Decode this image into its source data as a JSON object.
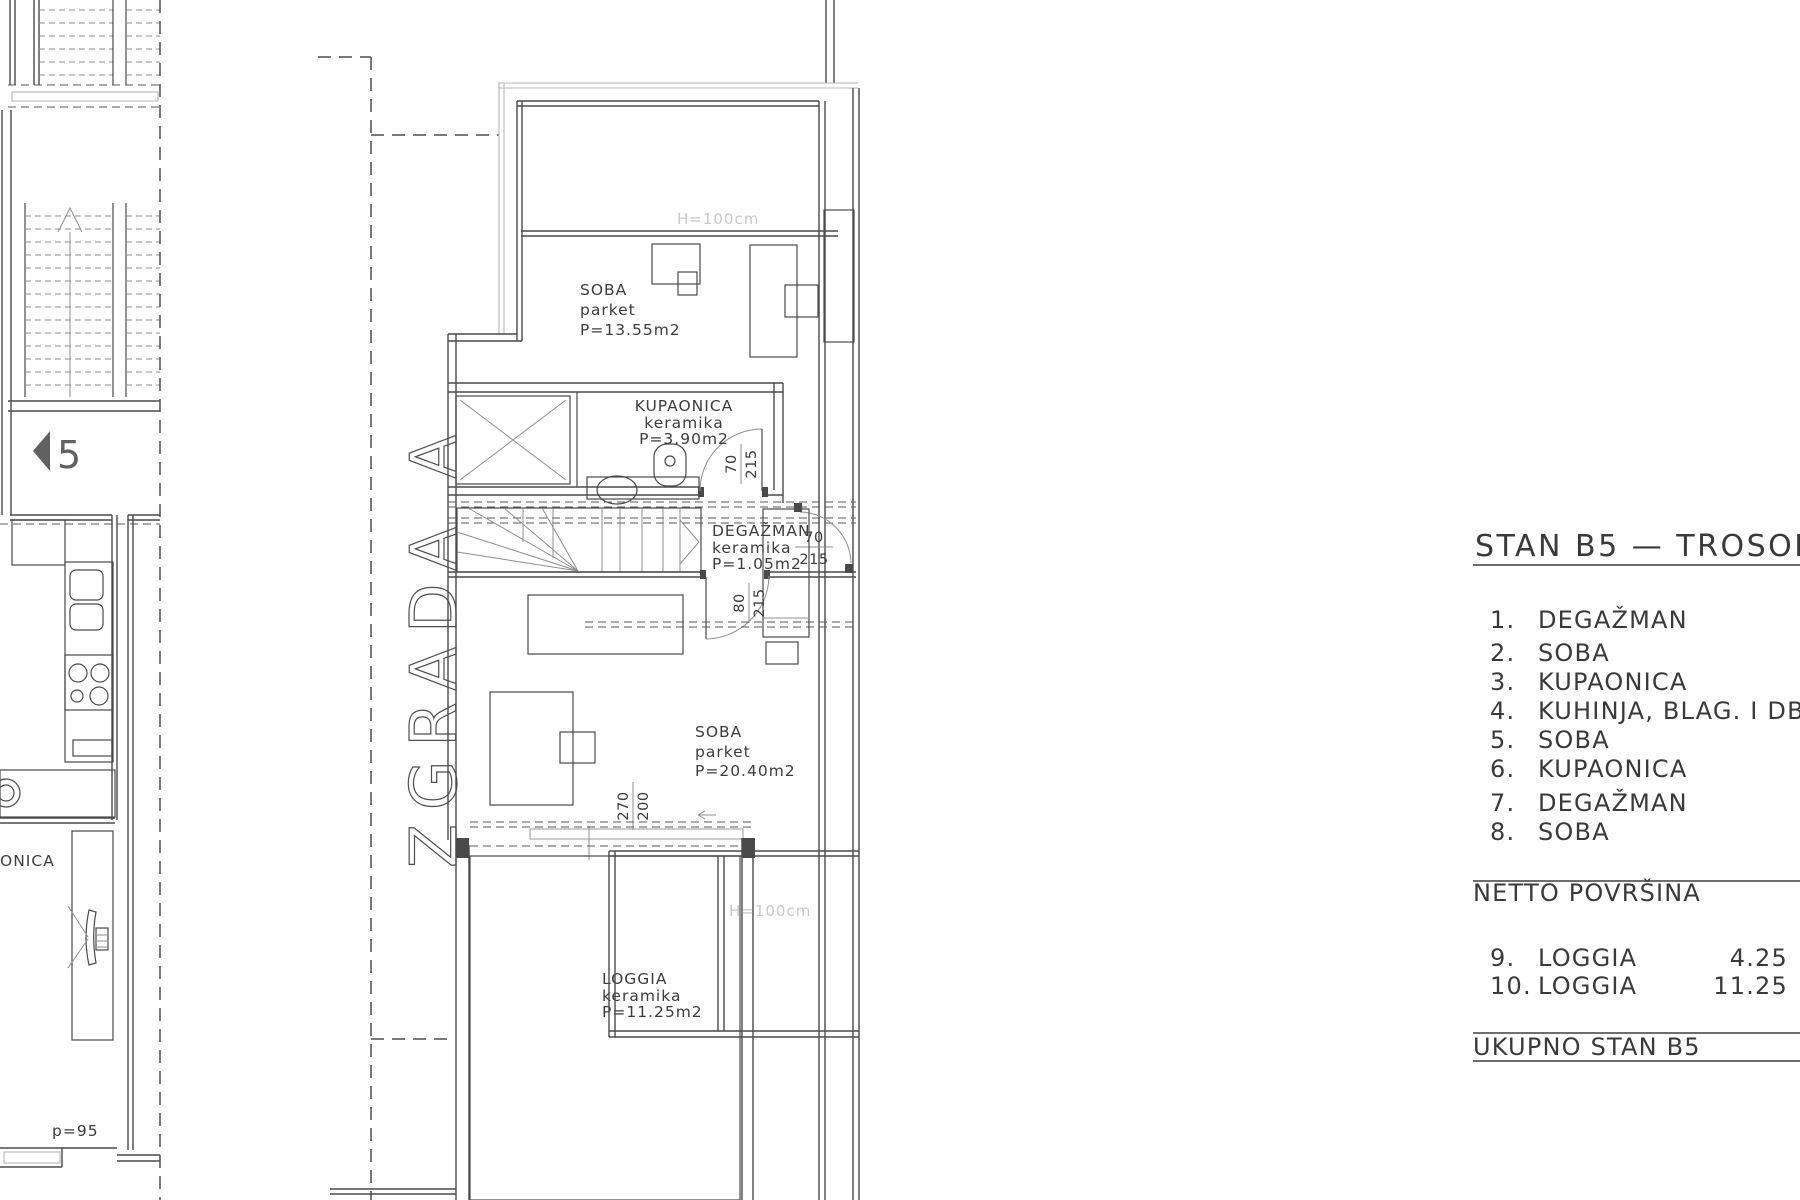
{
  "building_label": "ZGRADA A",
  "plan": {
    "rooms": {
      "soba1": {
        "name": "SOBA",
        "floor": "parket",
        "area": "P=13.55m2"
      },
      "kupaonica": {
        "name": "KUPAONICA",
        "floor": "keramika",
        "area": "P=3.90m2"
      },
      "degazman": {
        "name": "DEGAŽMAN",
        "floor": "keramika",
        "area": "P=1.05m2"
      },
      "soba2": {
        "name": "SOBA",
        "floor": "parket",
        "area": "P=20.40m2"
      },
      "loggia": {
        "name": "LOGGIA",
        "floor": "keramika",
        "area": "P=11.25m2"
      }
    },
    "dims": {
      "bath_door_w": "70",
      "bath_door_h": "215",
      "hall_door_w": "70",
      "hall_door_h": "215",
      "room_door_w": "80",
      "room_door_h": "215",
      "loggia_open_w": "270",
      "loggia_open_h": "200"
    },
    "annotations": {
      "parapet_top": "H=100cm",
      "parapet_bottom": "H=100cm",
      "section_marker": "5",
      "neighbor_room_partial": "ONICA",
      "parapet_left": "p=95"
    }
  },
  "panel": {
    "title": "STAN B5 — TROSOB",
    "items": [
      {
        "num": "1.",
        "label": "DEGAŽMAN"
      },
      {
        "num": "2.",
        "label": "SOBA"
      },
      {
        "num": "3.",
        "label": "KUPAONICA"
      },
      {
        "num": "4.",
        "label": "KUHINJA, BLAG. I DB"
      },
      {
        "num": "5.",
        "label": "SOBA"
      },
      {
        "num": "6.",
        "label": "KUPAONICA"
      },
      {
        "num": "7.",
        "label": "DEGAŽMAN"
      },
      {
        "num": "8.",
        "label": "SOBA"
      }
    ],
    "netto_heading": "NETTO POVRŠINA",
    "netto_items": [
      {
        "num": "9.",
        "label": "LOGGIA",
        "value": "4.25"
      },
      {
        "num": "10.",
        "label": "LOGGIA",
        "value": "11.25"
      }
    ],
    "total_label": "UKUPNO STAN B5"
  },
  "colors": {
    "line": "#4a4a4a",
    "light_line": "#b9b9b9",
    "faint_text": "#c9c9c9",
    "red_furniture": "#9a4444"
  }
}
